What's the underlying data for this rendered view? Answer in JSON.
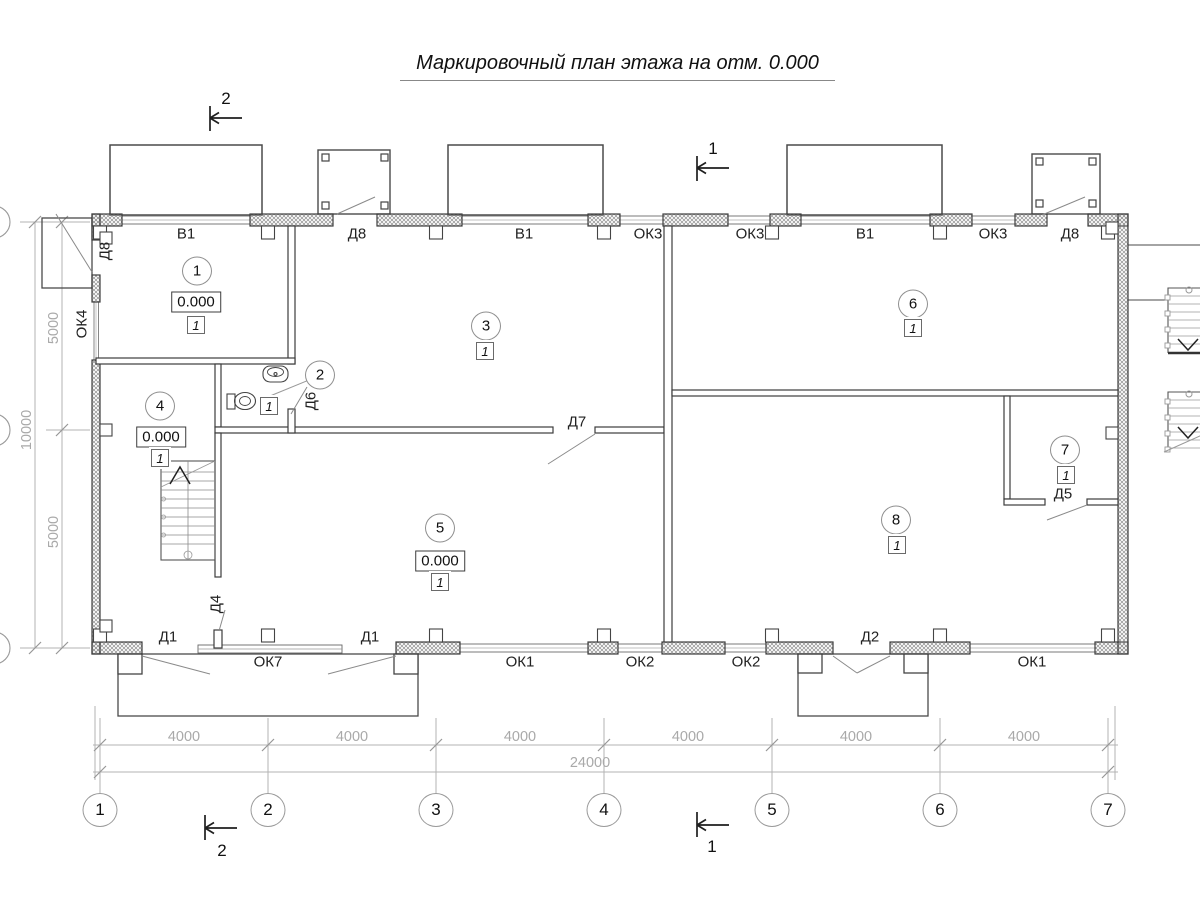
{
  "title": "Маркировочный план этажа на отм. 0.000",
  "rooms": [
    {
      "num": "1",
      "cx": 197,
      "cy": 271,
      "elev": "0.000",
      "ex": 196,
      "ey": 302,
      "type": "1",
      "tx": 196,
      "ty": 325
    },
    {
      "num": "2",
      "cx": 320,
      "cy": 375,
      "type": "1",
      "tx": 269,
      "ty": 406
    },
    {
      "num": "3",
      "cx": 486,
      "cy": 326,
      "type": "1",
      "tx": 485,
      "ty": 351
    },
    {
      "num": "4",
      "cx": 160,
      "cy": 406,
      "elev": "0.000",
      "ex": 161,
      "ey": 437,
      "type": "1",
      "tx": 160,
      "ty": 458
    },
    {
      "num": "5",
      "cx": 440,
      "cy": 528,
      "elev": "0.000",
      "ex": 440,
      "ey": 561,
      "type": "1",
      "tx": 440,
      "ty": 582
    },
    {
      "num": "6",
      "cx": 913,
      "cy": 304,
      "type": "1",
      "tx": 913,
      "ty": 328
    },
    {
      "num": "7",
      "cx": 1065,
      "cy": 450,
      "type": "1",
      "tx": 1066,
      "ty": 475
    },
    {
      "num": "8",
      "cx": 896,
      "cy": 520,
      "type": "1",
      "tx": 897,
      "ty": 545
    }
  ],
  "openings": [
    {
      "text": "В1",
      "x": 186,
      "y": 234
    },
    {
      "text": "Д8",
      "x": 357,
      "y": 234
    },
    {
      "text": "В1",
      "x": 524,
      "y": 234
    },
    {
      "text": "ОК3",
      "x": 648,
      "y": 234
    },
    {
      "text": "ОК3",
      "x": 750,
      "y": 234
    },
    {
      "text": "В1",
      "x": 865,
      "y": 234
    },
    {
      "text": "ОК3",
      "x": 993,
      "y": 234
    },
    {
      "text": "Д8",
      "x": 1070,
      "y": 234
    },
    {
      "text": "Д8",
      "x": 105,
      "y": 251,
      "rot": true
    },
    {
      "text": "ОК4",
      "x": 82,
      "y": 324,
      "rot": true
    },
    {
      "text": "Д6",
      "x": 311,
      "y": 401,
      "rot": true
    },
    {
      "text": "Д7",
      "x": 577,
      "y": 422
    },
    {
      "text": "Д4",
      "x": 216,
      "y": 604,
      "rot": true
    },
    {
      "text": "Д5",
      "x": 1063,
      "y": 494
    },
    {
      "text": "Д1",
      "x": 168,
      "y": 637
    },
    {
      "text": "Д1",
      "x": 370,
      "y": 637
    },
    {
      "text": "Д2",
      "x": 870,
      "y": 637
    },
    {
      "text": "ОК7",
      "x": 268,
      "y": 662
    },
    {
      "text": "ОК1",
      "x": 520,
      "y": 662
    },
    {
      "text": "ОК2",
      "x": 640,
      "y": 662
    },
    {
      "text": "ОК2",
      "x": 746,
      "y": 662
    },
    {
      "text": "ОК1",
      "x": 1032,
      "y": 662
    }
  ],
  "axes": {
    "bottom": [
      {
        "label": "1",
        "x": 100
      },
      {
        "label": "2",
        "x": 268
      },
      {
        "label": "3",
        "x": 436
      },
      {
        "label": "4",
        "x": 604
      },
      {
        "label": "5",
        "x": 772
      },
      {
        "label": "6",
        "x": 940
      },
      {
        "label": "7",
        "x": 1108
      }
    ],
    "bubble_y": 810
  },
  "dims": {
    "bottom_segments": [
      {
        "text": "4000",
        "x": 184
      },
      {
        "text": "4000",
        "x": 352
      },
      {
        "text": "4000",
        "x": 520
      },
      {
        "text": "4000",
        "x": 688
      },
      {
        "text": "4000",
        "x": 856
      },
      {
        "text": "4000",
        "x": 1024
      }
    ],
    "bottom_y": 737,
    "total": {
      "text": "24000",
      "x": 590,
      "y": 763
    },
    "left": [
      {
        "text": "5000",
        "x": 54,
        "y": 328
      },
      {
        "text": "10000",
        "x": 27,
        "y": 430
      },
      {
        "text": "5000",
        "x": 54,
        "y": 532
      }
    ]
  },
  "sections": [
    {
      "label": "2",
      "x": 226,
      "y": 99
    },
    {
      "label": "1",
      "x": 713,
      "y": 149
    },
    {
      "label": "2",
      "x": 222,
      "y": 851
    },
    {
      "label": "1",
      "x": 712,
      "y": 847
    }
  ],
  "colors": {
    "line": "#3c3c3c",
    "dim": "#b3b3b3",
    "hatch": "#8f8f8f"
  }
}
